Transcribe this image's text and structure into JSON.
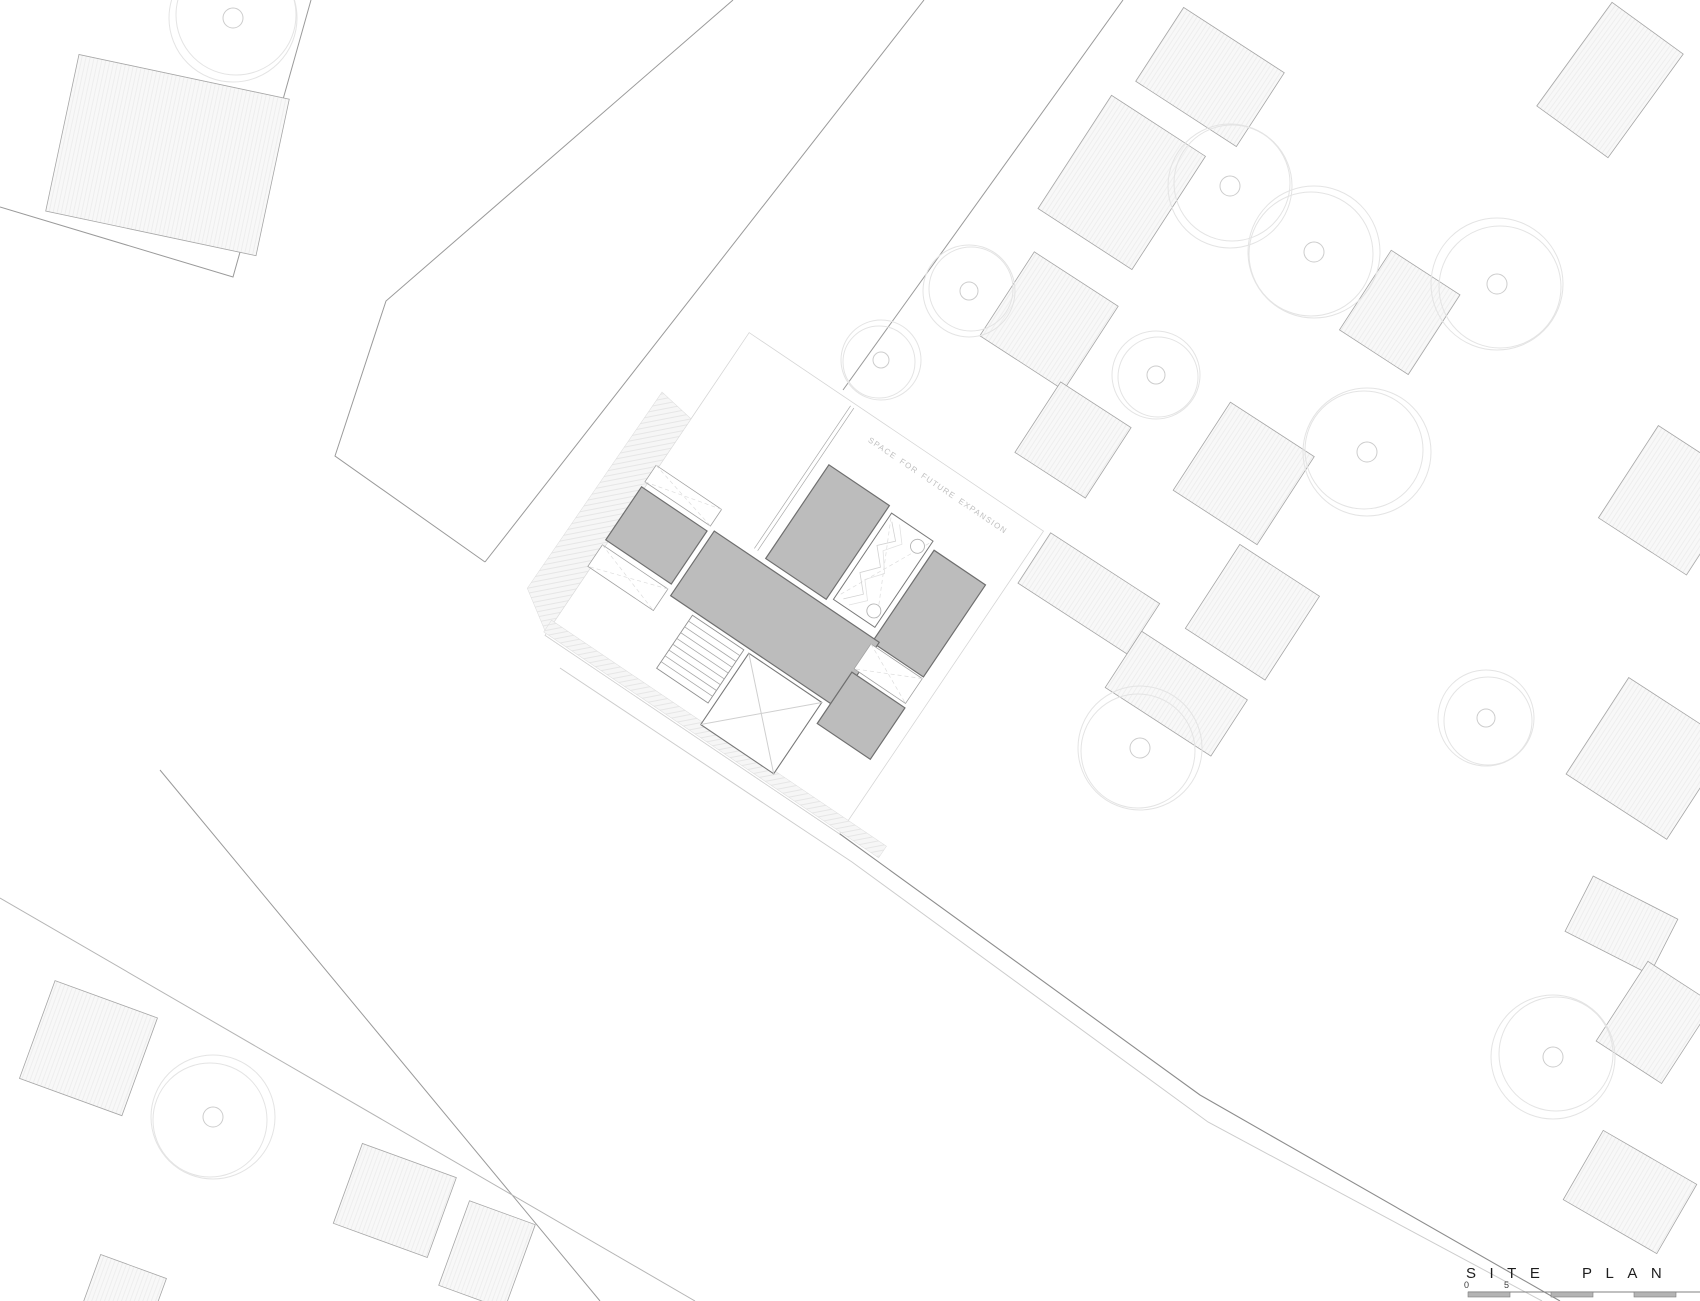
{
  "annotations": {
    "future_expansion": "SPACE FOR FUTURE EXPANSION"
  },
  "title_block": {
    "title": "SITE PLAN",
    "scale_labels": [
      "0",
      "5"
    ]
  },
  "palette": {
    "road_line": "#9a9a9a",
    "strong_road_line": "#8d8d8d",
    "faint_line": "#cdcdcd",
    "neighbor_building_fill": "#f8f8f8",
    "neighbor_building_stroke": "#a6a6a6",
    "house_fill": "#bcbcbc",
    "house_stroke": "#6f6f6f",
    "tree_outline": "#e4e4e4",
    "annotation_text": "#c0c0c0",
    "title_text": "#1d1d1d",
    "scale_bar_fill": "#b4b4b4"
  }
}
